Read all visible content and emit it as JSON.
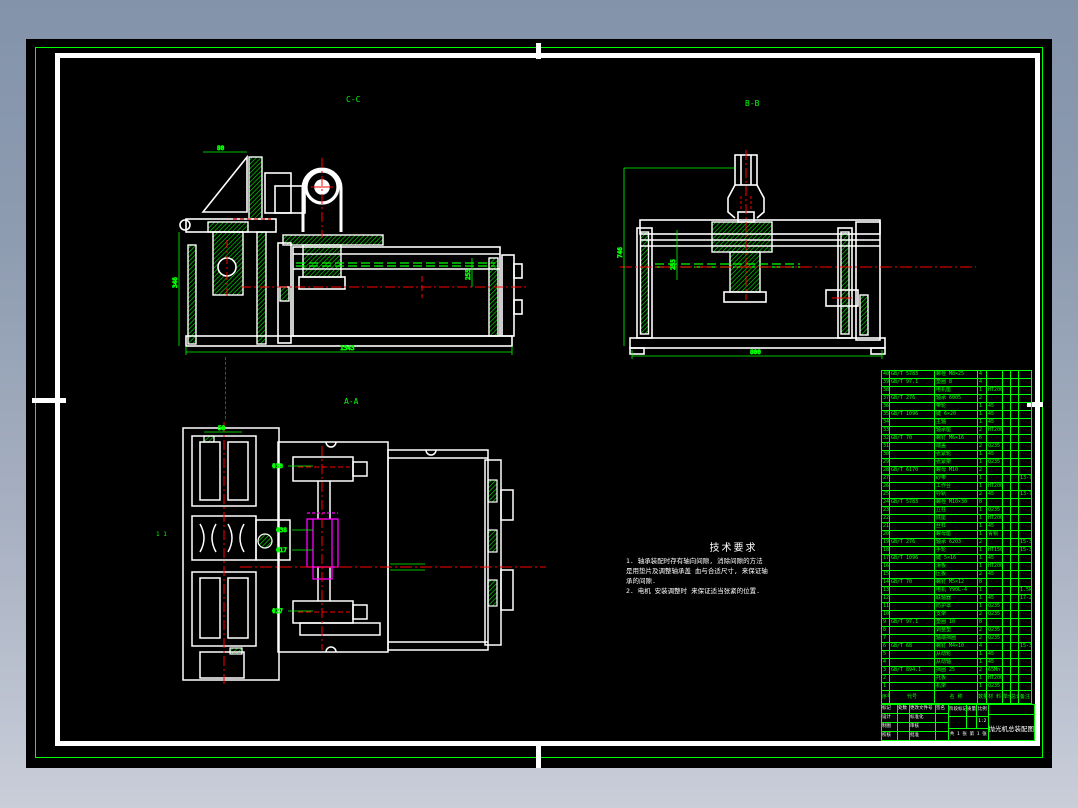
{
  "colors": {
    "line_green": "#00ff00",
    "line_white": "#ffffff",
    "line_red": "#ff0000",
    "line_magenta": "#ff00ff",
    "sheet": "#000000"
  },
  "views": {
    "cc": {
      "label": "C-C",
      "dim_bottom": "1343",
      "dim_left": "346",
      "dim_top": "80",
      "dim_right": "255"
    },
    "bb": {
      "label": "B-B",
      "dim_bottom": "800",
      "dim_left": "746",
      "dim_mid": "255"
    },
    "aa": {
      "label": "A-A",
      "scale_mark": "1 1",
      "leader_top": "Φ30",
      "leader_mid1": "Φ38",
      "leader_mid2": "Φ17",
      "leader_bottom": "Φ27",
      "dim_top": "58"
    }
  },
  "tech": {
    "title": "技术要求",
    "lines": [
      "1. 轴承装配时存有轴向间隙, 消除间隙的方法",
      "是用垫片及调整轴承盖 血与合适尺寸, 来保证轴",
      "承的间隙.",
      "2. 电机 安装调整时 来保证适当张紧的位置."
    ]
  },
  "bom": {
    "headers": {
      "no": "序号",
      "code": "代号",
      "name": "名 称",
      "qty": "数量",
      "mat": "材 料",
      "w1": "单件",
      "w2": "总计",
      "rem": "备注"
    },
    "rows": [
      {
        "n": "40",
        "c": "GB/T 5783",
        "m": "螺栓 M8×25",
        "q": "4",
        "mt": "",
        "r": ""
      },
      {
        "n": "39",
        "c": "GB/T 97.1",
        "m": "垫圈 8",
        "q": "4",
        "mt": "",
        "r": ""
      },
      {
        "n": "38",
        "c": "",
        "m": "电机座",
        "q": "1",
        "mt": "HT200",
        "r": ""
      },
      {
        "n": "37",
        "c": "GB/T 276",
        "m": "轴承 6005",
        "q": "2",
        "mt": "",
        "r": ""
      },
      {
        "n": "36",
        "c": "",
        "m": "带轮",
        "q": "1",
        "mt": "45",
        "r": ""
      },
      {
        "n": "35",
        "c": "GB/T 1096",
        "m": "键 6×20",
        "q": "1",
        "mt": "45",
        "r": ""
      },
      {
        "n": "34",
        "c": "",
        "m": "主轴",
        "q": "1",
        "mt": "45",
        "r": ""
      },
      {
        "n": "33",
        "c": "",
        "m": "轴承座",
        "q": "2",
        "mt": "HT200",
        "r": ""
      },
      {
        "n": "32",
        "c": "GB/T 70",
        "m": "螺钉 M6×16",
        "q": "6",
        "mt": "",
        "r": ""
      },
      {
        "n": "31",
        "c": "",
        "m": "端盖",
        "q": "2",
        "mt": "Q235",
        "r": ""
      },
      {
        "n": "30",
        "c": "",
        "m": "张紧轮",
        "q": "1",
        "mt": "45",
        "r": ""
      },
      {
        "n": "29",
        "c": "",
        "m": "张紧架",
        "q": "1",
        "mt": "Q235",
        "r": ""
      },
      {
        "n": "28",
        "c": "GB/T 6170",
        "m": "螺母 M10",
        "q": "2",
        "mt": "",
        "r": ""
      },
      {
        "n": "27",
        "c": "",
        "m": "砂带",
        "q": "1",
        "mt": "",
        "r": "13-73"
      },
      {
        "n": "26",
        "c": "",
        "m": "工作台",
        "q": "1",
        "mt": "HT200",
        "r": ""
      },
      {
        "n": "25",
        "c": "",
        "m": "导轨",
        "q": "2",
        "mt": "45",
        "r": "13-73"
      },
      {
        "n": "24",
        "c": "GB/T 5783",
        "m": "螺栓 M10×30",
        "q": "8",
        "mt": "",
        "r": ""
      },
      {
        "n": "23",
        "c": "",
        "m": "立柱",
        "q": "1",
        "mt": "Q235",
        "r": ""
      },
      {
        "n": "22",
        "c": "",
        "m": "底座",
        "q": "1",
        "mt": "HT200",
        "r": ""
      },
      {
        "n": "21",
        "c": "",
        "m": "丝杠",
        "q": "1",
        "mt": "45",
        "r": ""
      },
      {
        "n": "20",
        "c": "",
        "m": "螺母座",
        "q": "1",
        "mt": "青铜",
        "r": ""
      },
      {
        "n": "19",
        "c": "GB/T 276",
        "m": "轴承 6203",
        "q": "2",
        "mt": "",
        "r": "15-35"
      },
      {
        "n": "18",
        "c": "",
        "m": "手轮",
        "q": "1",
        "mt": "HT150",
        "r": "15-35"
      },
      {
        "n": "17",
        "c": "GB/T 1096",
        "m": "键 5×16",
        "q": "1",
        "mt": "45",
        "r": ""
      },
      {
        "n": "16",
        "c": "",
        "m": "滑板",
        "q": "1",
        "mt": "HT200",
        "r": ""
      },
      {
        "n": "15",
        "c": "",
        "m": "压板",
        "q": "2",
        "mt": "45",
        "r": ""
      },
      {
        "n": "14",
        "c": "GB/T 70",
        "m": "螺钉 M5×12",
        "q": "8",
        "mt": "",
        "r": ""
      },
      {
        "n": "13",
        "c": "",
        "m": "电机 Y90L-4",
        "q": "1",
        "mt": "",
        "r": "1.5kW"
      },
      {
        "n": "12",
        "c": "",
        "m": "联轴器",
        "q": "1",
        "mt": "45",
        "r": "17-25"
      },
      {
        "n": "11",
        "c": "",
        "m": "防护罩",
        "q": "1",
        "mt": "Q235",
        "r": ""
      },
      {
        "n": "10",
        "c": "",
        "m": "支架",
        "q": "2",
        "mt": "Q235",
        "r": ""
      },
      {
        "n": "9",
        "c": "GB/T 97.1",
        "m": "垫圈 10",
        "q": "8",
        "mt": "",
        "r": ""
      },
      {
        "n": "8",
        "c": "",
        "m": "调整垫",
        "q": "2",
        "mt": "Q235",
        "r": ""
      },
      {
        "n": "7",
        "c": "",
        "m": "轴端挡圈",
        "q": "2",
        "mt": "Q235",
        "r": ""
      },
      {
        "n": "6",
        "c": "GB/T 68",
        "m": "螺钉 M4×10",
        "q": "4",
        "mt": "",
        "r": "15-35"
      },
      {
        "n": "5",
        "c": "",
        "m": "从动轮",
        "q": "1",
        "mt": "45",
        "r": ""
      },
      {
        "n": "4",
        "c": "",
        "m": "从动轴",
        "q": "1",
        "mt": "45",
        "r": ""
      },
      {
        "n": "3",
        "c": "GB/T 894.1",
        "m": "挡圈 25",
        "q": "2",
        "mt": "65Mn",
        "r": ""
      },
      {
        "n": "2",
        "c": "",
        "m": "托板",
        "q": "1",
        "mt": "HT200",
        "r": ""
      },
      {
        "n": "1",
        "c": "",
        "m": "机架",
        "q": "1",
        "mt": "Q235",
        "r": ""
      }
    ]
  },
  "titleblock": {
    "left_rows": [
      {
        "a": "标记",
        "b": "处数",
        "c": "更改文件号",
        "d": "签名"
      },
      {
        "a": "设计",
        "b": "",
        "c": "标准化",
        "d": ""
      },
      {
        "a": "制图",
        "b": "",
        "c": "审核",
        "d": ""
      },
      {
        "a": "校核",
        "b": "",
        "c": "批准",
        "d": ""
      }
    ],
    "mid_headers": {
      "stage": "阶段标记",
      "mass": "质量",
      "scale": "比例"
    },
    "mid_values": {
      "stage": "",
      "mass": "",
      "scale": "1:2"
    },
    "sheets": "共 1 张 第 1 张",
    "title": "抛光机总装配图"
  }
}
